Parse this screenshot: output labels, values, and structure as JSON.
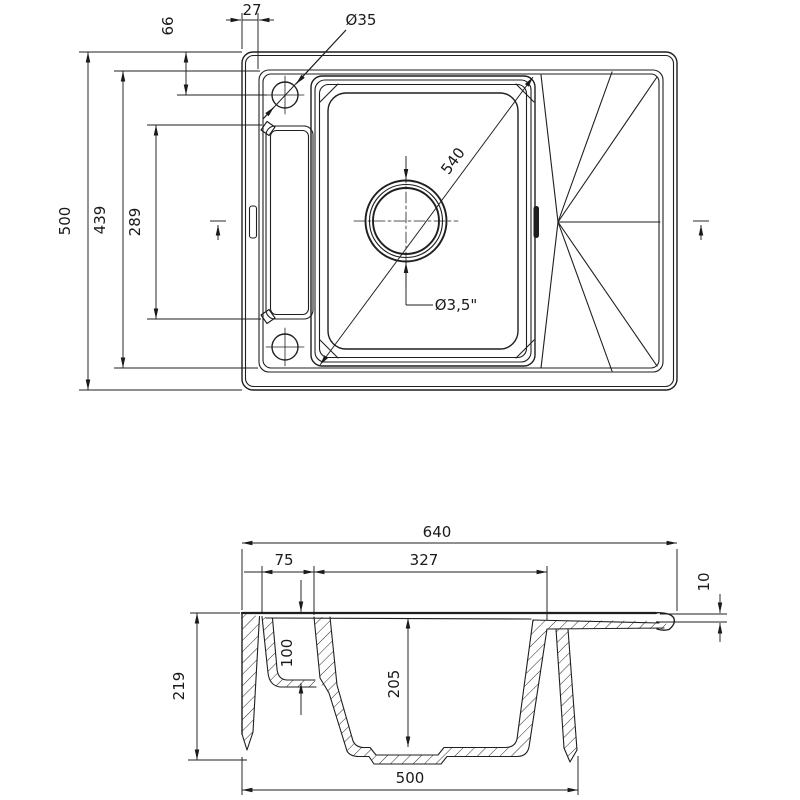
{
  "drawing": {
    "description": "Technical drawing of a one-bowl kitchen sink with drainboard, top view and cross-section",
    "ink_color": "#1f1f1f",
    "background_color": "#ffffff",
    "top_view": {
      "dim_outer_height": "500",
      "dim_inner_height": "439",
      "dim_recess_length": "289",
      "dim_hole_top_offset": "66",
      "dim_edge_offset": "27",
      "dim_tap_hole_diameter": "Ø35",
      "dim_bowl_diagonal": "540",
      "dim_drain_diameter": "Ø3,5\""
    },
    "section_view": {
      "dim_overall_width": "640",
      "dim_recess_width": "75",
      "dim_bowl_opening": "327",
      "dim_edge_thickness": "10",
      "dim_overall_depth": "219",
      "dim_recess_depth": "100",
      "dim_bowl_depth": "205",
      "dim_base_width": "500"
    }
  }
}
